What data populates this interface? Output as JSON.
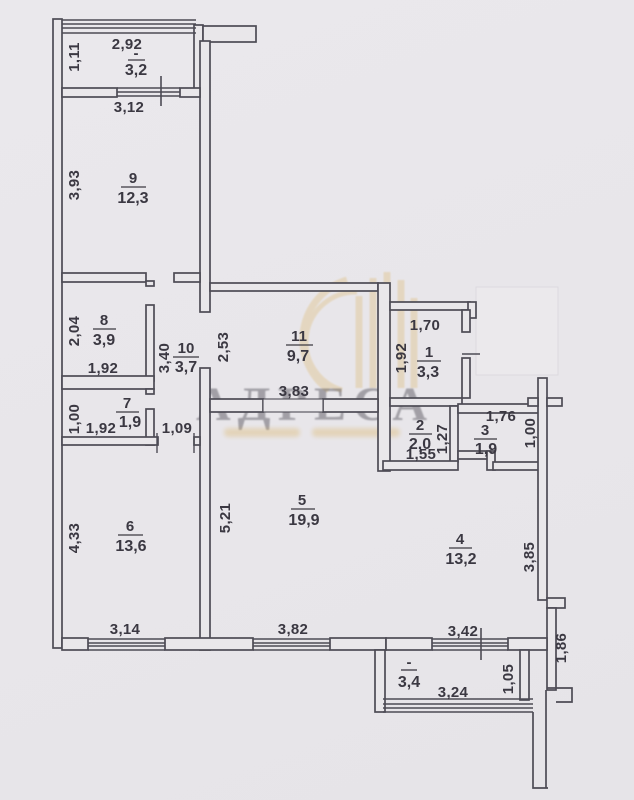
{
  "meta": {
    "paper_color": "#e9e7ea",
    "line_color": "#4d4c55",
    "text_color": "#3a3942",
    "watermark_color": "#d9ae54"
  },
  "watermark": {
    "title": "АДРЕСА"
  },
  "rooms": [
    {
      "key": "balcony_top",
      "number": "-",
      "area": "3,2",
      "dims": {
        "top": "2,92",
        "left": "1,11"
      }
    },
    {
      "key": "room9",
      "number": "9",
      "area": "12,3",
      "dims": {
        "top": "3,12",
        "left": "3,93"
      }
    },
    {
      "key": "room8",
      "number": "8",
      "area": "3,9",
      "dims": {
        "left": "2,04",
        "bottom": "1,92"
      }
    },
    {
      "key": "room10",
      "number": "10",
      "area": "3,7",
      "dims": {
        "side": "3,40",
        "bottom": "1,09"
      }
    },
    {
      "key": "room7",
      "number": "7",
      "area": "1,9",
      "dims": {
        "left": "1,00",
        "bottom": "1,92"
      }
    },
    {
      "key": "room11",
      "number": "11",
      "area": "9,7",
      "dims": {
        "left": "2,53",
        "bottom": "3,83"
      }
    },
    {
      "key": "room1",
      "number": "1",
      "area": "3,3",
      "dims": {
        "top": "1,70",
        "left": "1,92"
      }
    },
    {
      "key": "room2",
      "number": "2",
      "area": "2,0",
      "dims": {
        "right": "1,27",
        "bottom": "1,55"
      }
    },
    {
      "key": "room3",
      "number": "3",
      "area": "1,9",
      "dims": {
        "top": "1,76",
        "right": "1,00"
      }
    },
    {
      "key": "room6",
      "number": "6",
      "area": "13,6",
      "dims": {
        "left": "4,33",
        "bottom": "3,14"
      }
    },
    {
      "key": "room5",
      "number": "5",
      "area": "19,9",
      "dims": {
        "left": "5,21",
        "bottom": "3,82"
      }
    },
    {
      "key": "room4",
      "number": "4",
      "area": "13,2",
      "dims": {
        "right": "3,85",
        "bottom": "3,42"
      }
    },
    {
      "key": "balcony_bottom",
      "number": "-",
      "area": "3,4",
      "dims": {
        "bottom": "3,24",
        "right": "1,05"
      }
    }
  ],
  "outside_dims": {
    "right_side": "1,86"
  }
}
